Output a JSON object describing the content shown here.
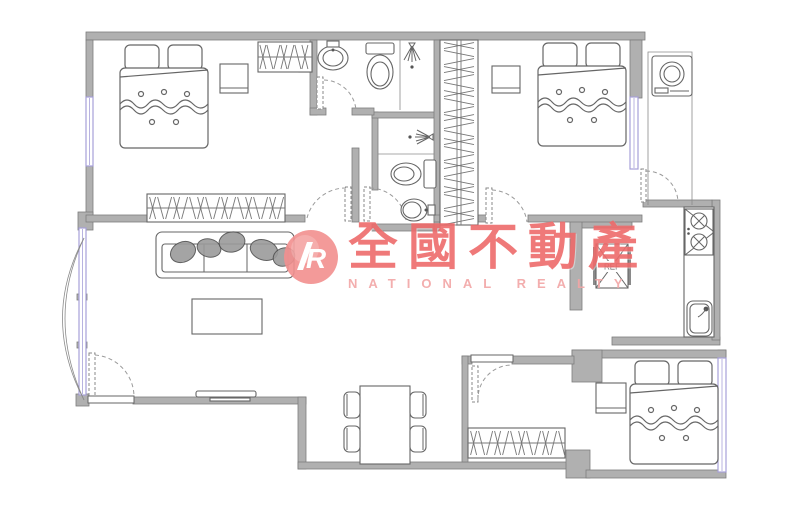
{
  "watermark": {
    "logo_letter": "R",
    "brand_cn": "全國不動產",
    "brand_en": "NATIONAL REALTY"
  },
  "labels": {
    "fridge": "REF"
  },
  "colors": {
    "wall_fill": "#b0b0b0",
    "wall_stroke": "#7d7d7d",
    "drawing_line": "#666666",
    "window_accent": "#a7a0d8",
    "watermark_red": "#ee6b6b",
    "watermark_red_light": "#f2a6a6",
    "logo_pink": "#f2908f"
  },
  "icons": [
    "double-bed-icon",
    "pillow-icon",
    "wardrobe-hangers-icon",
    "nightstand-icon",
    "sofa-icon",
    "coffee-table-icon",
    "tv-icon",
    "dining-table-icon",
    "chair-icon",
    "toilet-icon",
    "washbasin-icon",
    "shower-head-icon",
    "washing-machine-icon",
    "stove-icon",
    "kitchen-sink-icon",
    "refrigerator-icon",
    "door-swing-icon",
    "window-icon",
    "bay-window-arc-icon"
  ]
}
